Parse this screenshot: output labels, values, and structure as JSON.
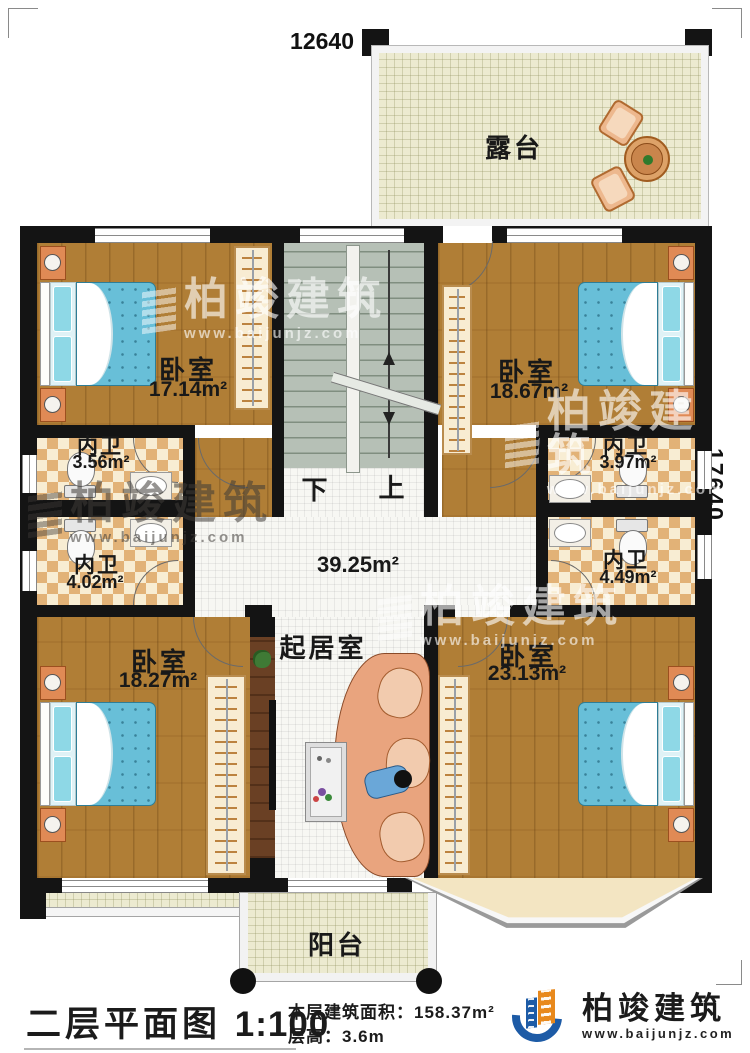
{
  "plan": {
    "dim_top": "12640",
    "dim_right": "17640",
    "rooms": {
      "terrace": {
        "label": "露台"
      },
      "bedroom_tl": {
        "label": "卧室",
        "area": "17.14m²"
      },
      "bedroom_tr": {
        "label": "卧室",
        "area": "18.67m²"
      },
      "bath_tl": {
        "label": "内卫",
        "area": "3.56m²"
      },
      "bath_tr": {
        "label": "内卫",
        "area": "3.97m²"
      },
      "bath_bl": {
        "label": "内卫",
        "area": "4.02m²"
      },
      "bath_br": {
        "label": "内卫",
        "area": "4.49m²"
      },
      "hall": {
        "area": "39.25m²"
      },
      "living": {
        "label": "起居室"
      },
      "bedroom_bl": {
        "label": "卧室",
        "area": "18.27m²"
      },
      "bedroom_br": {
        "label": "卧室",
        "area": "23.13m²"
      },
      "balcony": {
        "label": "阳台"
      }
    },
    "stairs": {
      "down": "下",
      "up": "上"
    }
  },
  "caption": {
    "title": "二层平面图",
    "scale": "1:100",
    "area_label": "本层建筑面积：",
    "area_value": "158.37m²",
    "floor_height_label": "层高：",
    "floor_height_value": "3.6m"
  },
  "brand": {
    "name": "柏竣建筑",
    "website": "www.baijunjz.com"
  },
  "watermark": {
    "name": "柏竣建筑",
    "website": "www.baijunjz.com"
  },
  "colors": {
    "wall": "#141414",
    "wood": "#b07e36",
    "tile_dark": "#e2b277",
    "tile_light": "#f8edd3",
    "bed": "#68bfd8",
    "stairs": "#b6c0b6",
    "terrace": "#ecead0",
    "logo_blue": "#1d5ba6",
    "logo_orange": "#e8891d"
  }
}
